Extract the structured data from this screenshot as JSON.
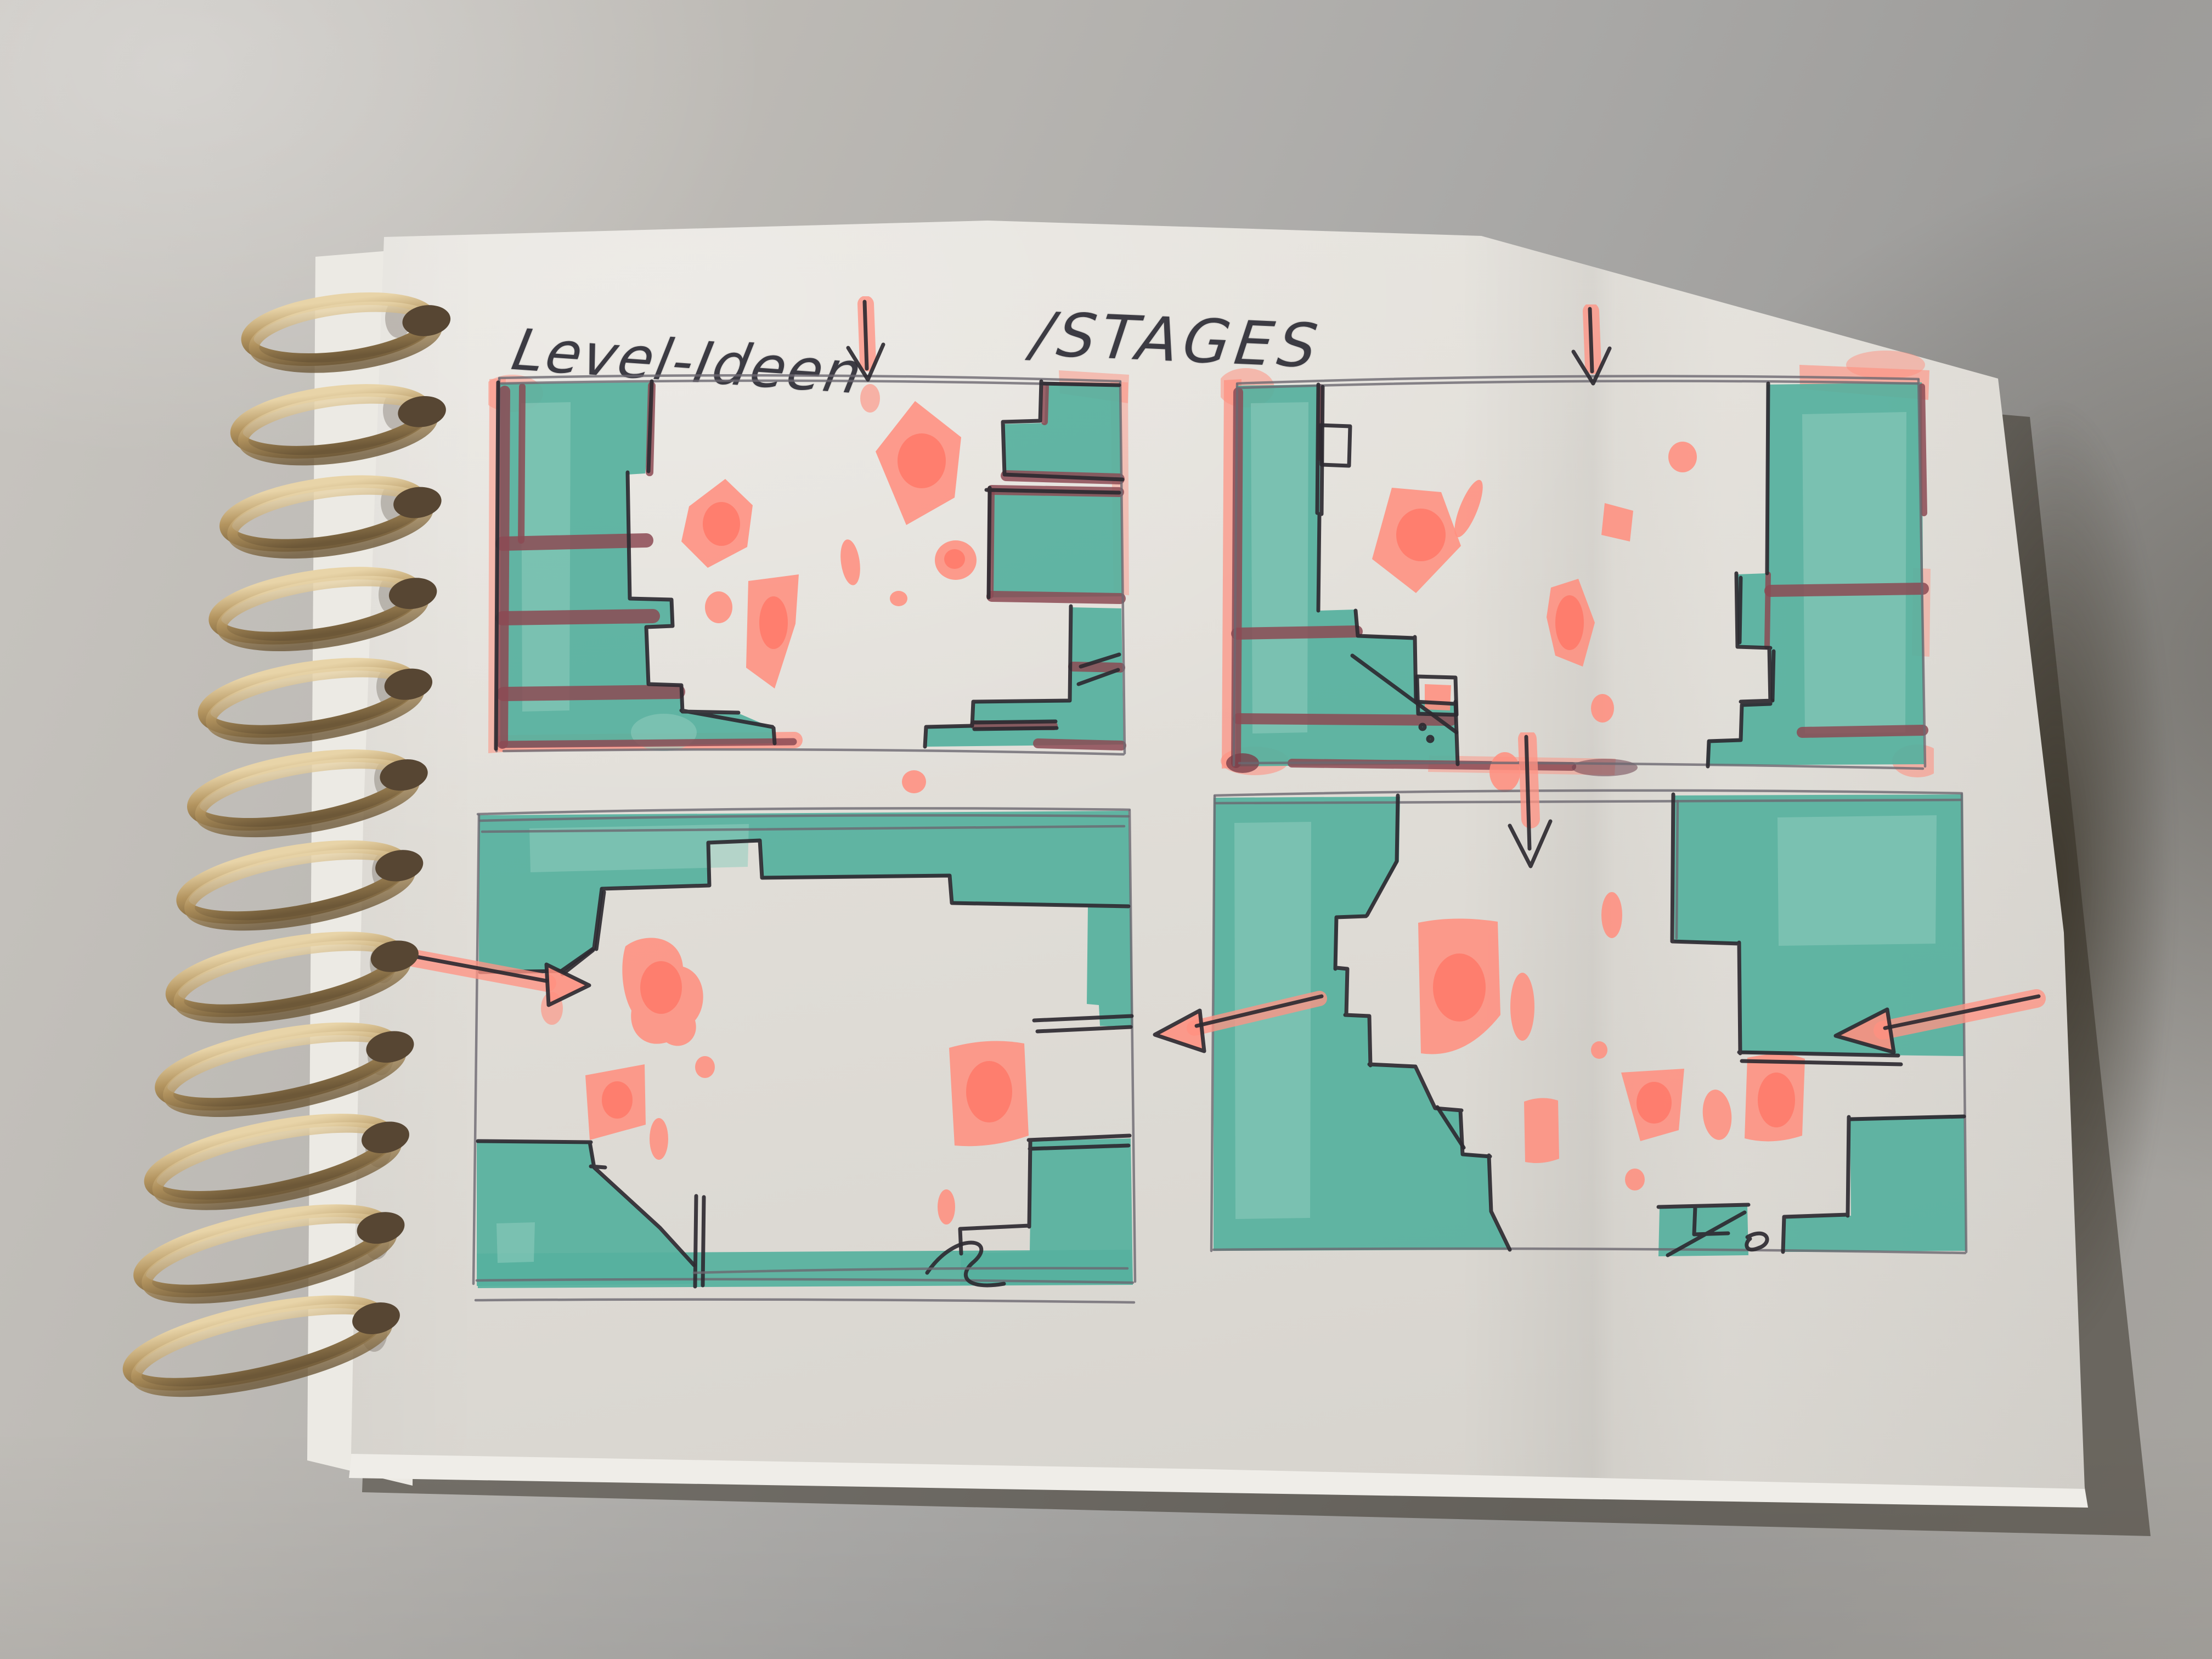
{
  "photo": {
    "handwritten_title": "Level-Ideen",
    "handwritten_subtitle": "/STAGES",
    "notebook": {
      "binding_style": "brass wire spiral, left edge",
      "coil_count": 12,
      "paper": "white sketch paper"
    },
    "sketch_panels": [
      {
        "name": "stage-idea-1",
        "position": "top-left",
        "content": "side walls of teal terrain with stepped ledges and maroon stripes, pink pickups floating in the middle",
        "annotations": [
          "small arrow pointing down into the top opening"
        ]
      },
      {
        "name": "stage-idea-2",
        "position": "top-right",
        "content": "two large teal towers left and right with notches, pink pickups in the central gap",
        "annotations": [
          "small arrow pointing down into the top opening"
        ]
      },
      {
        "name": "stage-idea-3",
        "position": "bottom-left",
        "content": "teal ring of terrain around an open arena, pink pickup clusters left and right",
        "annotations": [
          "arrow entering from the left side",
          "arrow entering from the right side"
        ]
      },
      {
        "name": "stage-idea-4",
        "position": "bottom-right",
        "content": "teal cliff on the left, floating blocks top-right and bottom-right, scattered pink pickups",
        "annotations": [
          "long arrow pointing down into the top",
          "arrow entering from the right side"
        ]
      }
    ],
    "palette": {
      "terrain_teal": "#56b09e",
      "pickup_pink": "#ff8f7f",
      "accent_maroon": "#8c4a53",
      "ink_pen": "#2e2a31",
      "pencil_grey": "#6b6871",
      "paper_white": "#e2dfd9",
      "desk_grey": "#aaa8a5",
      "coil_brass": "#a9895a"
    }
  }
}
